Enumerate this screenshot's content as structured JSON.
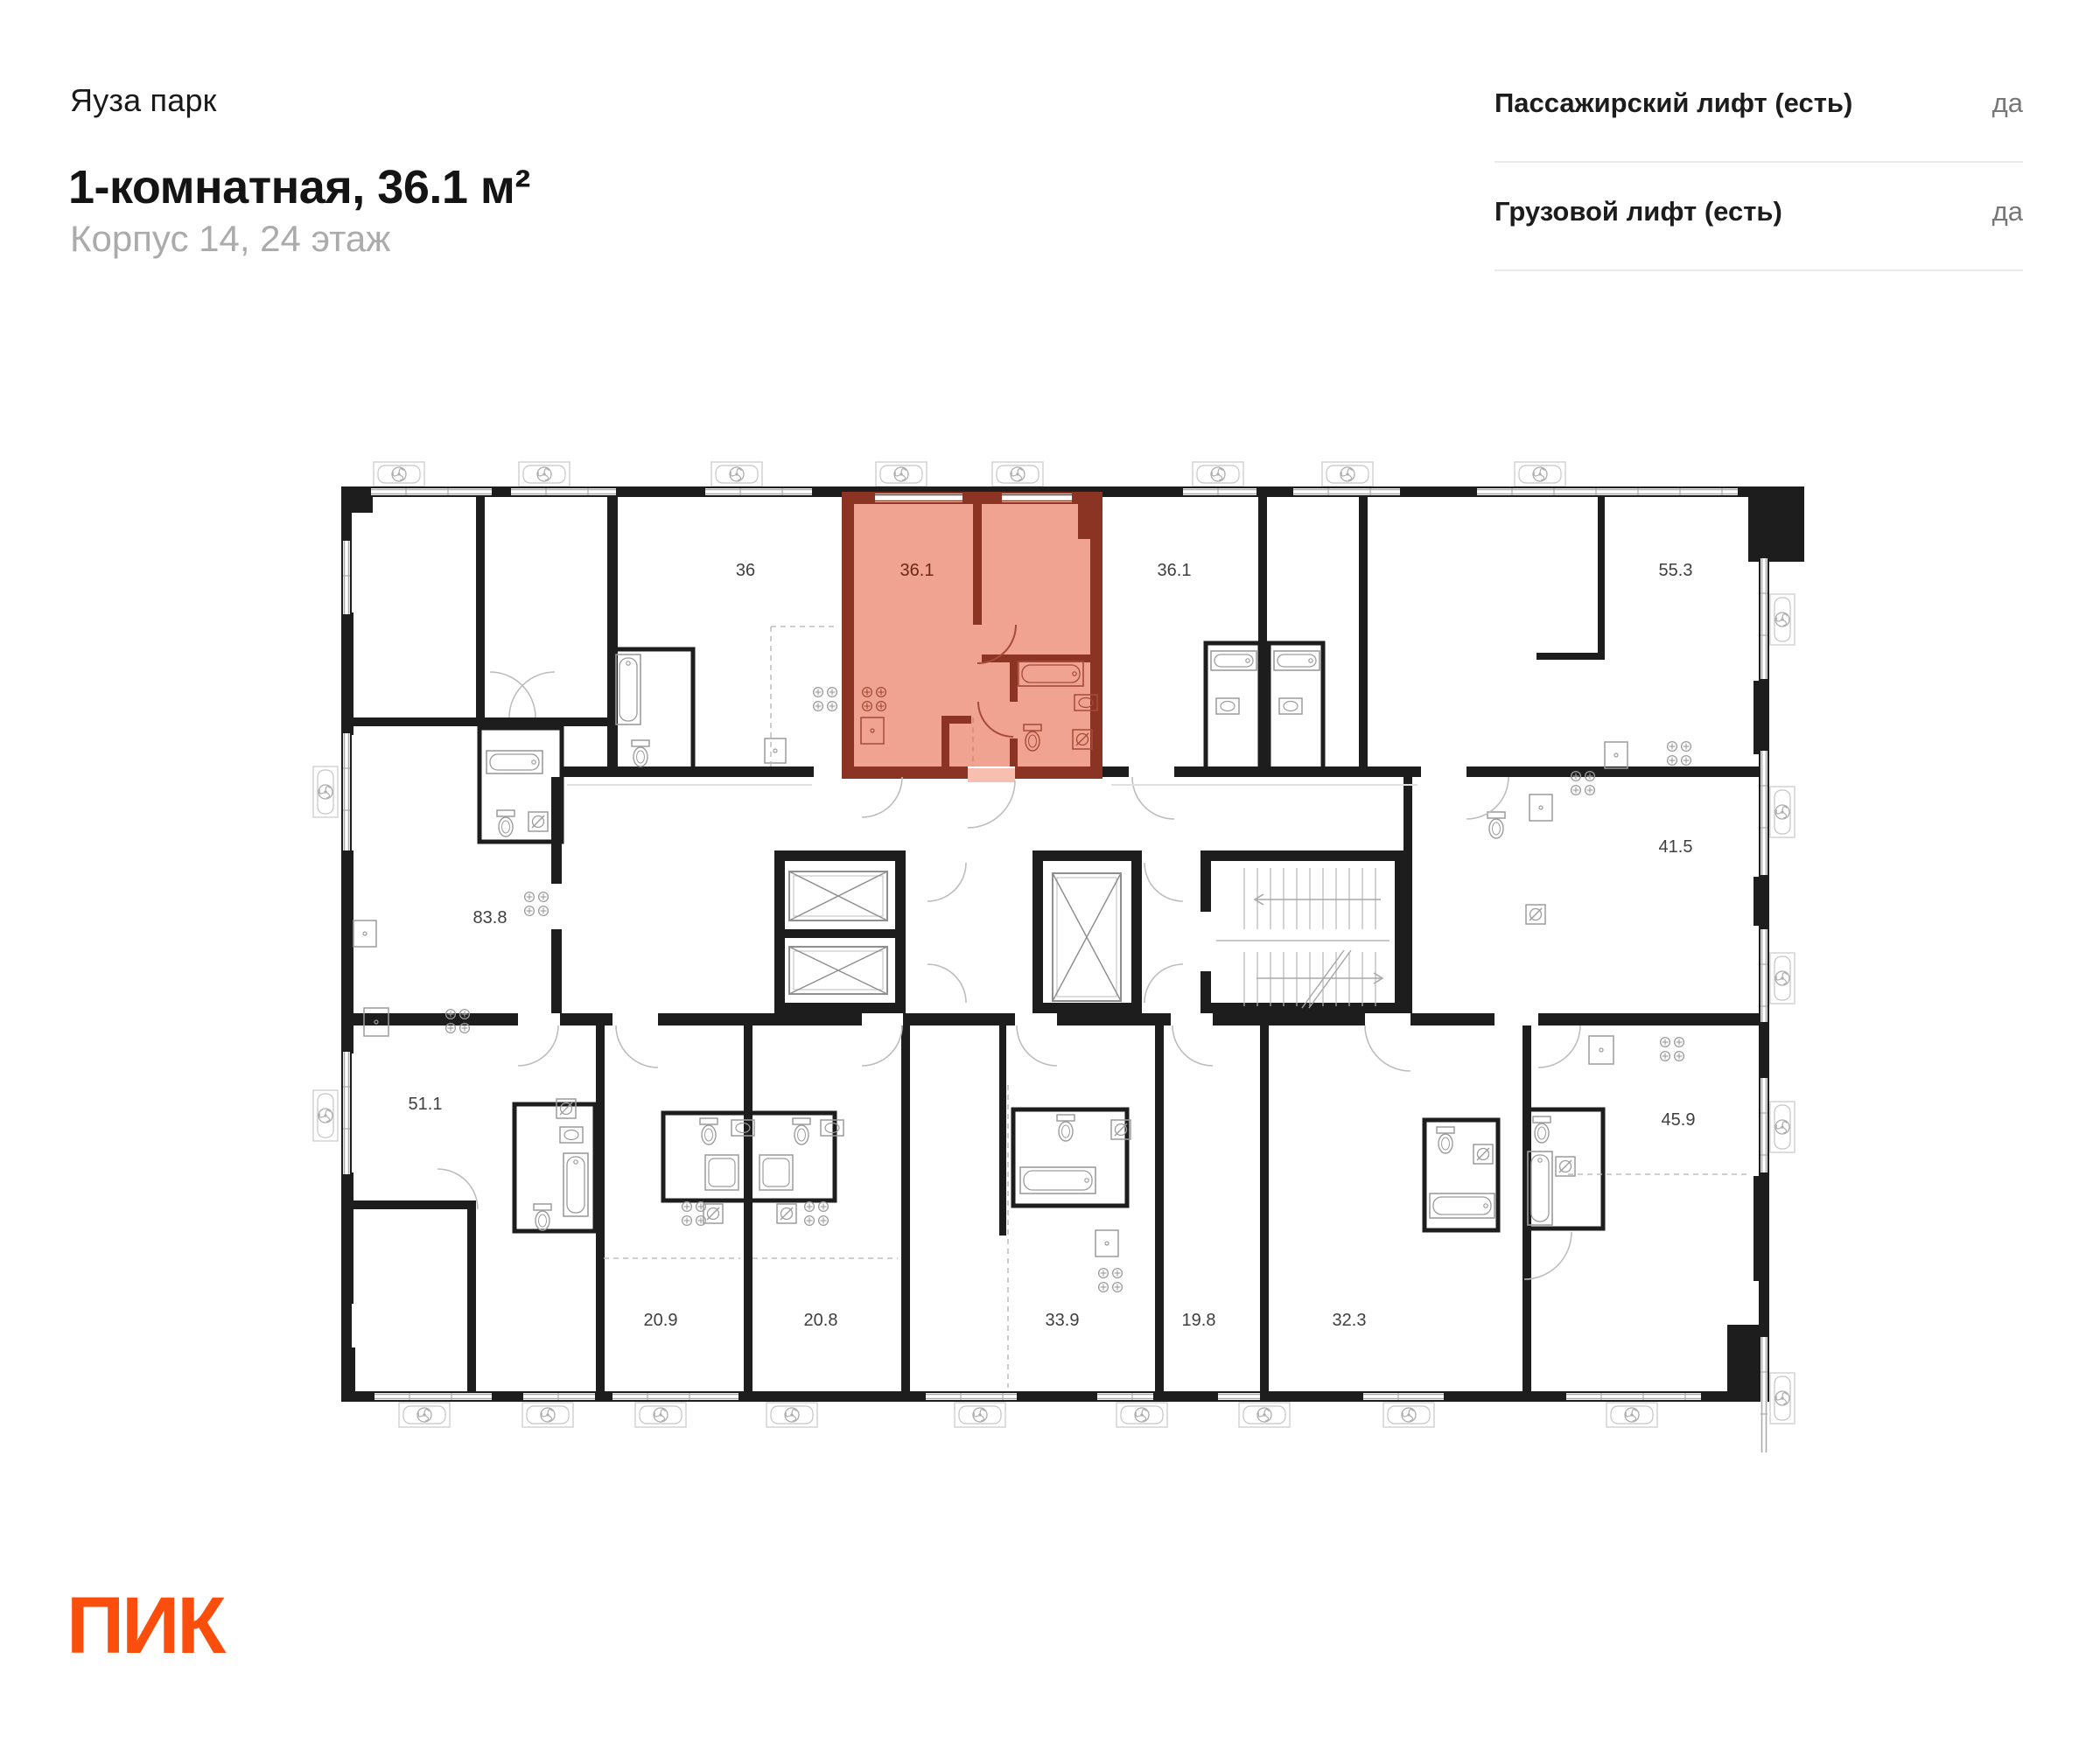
{
  "header": {
    "project": "Яуза парк",
    "title": "1-комнатная, 36.1 м²",
    "subtitle": "Корпус 14, 24 этаж"
  },
  "info": {
    "rows": [
      {
        "label": "Пассажирский лифт (есть)",
        "value": "да"
      },
      {
        "label": "Грузовой лифт (есть)",
        "value": "да"
      }
    ]
  },
  "plan": {
    "highlighted_unit": {
      "area": "36.1",
      "fill_color": "#F0A391",
      "wall_color": "#8C3423"
    },
    "unit_labels": [
      {
        "area": "36"
      },
      {
        "area": "36.1"
      },
      {
        "area": "36.1"
      },
      {
        "area": "55.3"
      },
      {
        "area": "41.5"
      },
      {
        "area": "83.8"
      },
      {
        "area": "51.1"
      },
      {
        "area": "45.9"
      },
      {
        "area": "20.9"
      },
      {
        "area": "20.8"
      },
      {
        "area": "33.9"
      },
      {
        "area": "19.8"
      },
      {
        "area": "32.3"
      }
    ]
  },
  "icons": {
    "fan": "vent-fan-icon",
    "elevator_shaft": "elevator-shaft-icon",
    "stairs": "stairs-icon"
  },
  "footer": {
    "logo": "ПИК",
    "brand_color": "#FB4E0C"
  }
}
